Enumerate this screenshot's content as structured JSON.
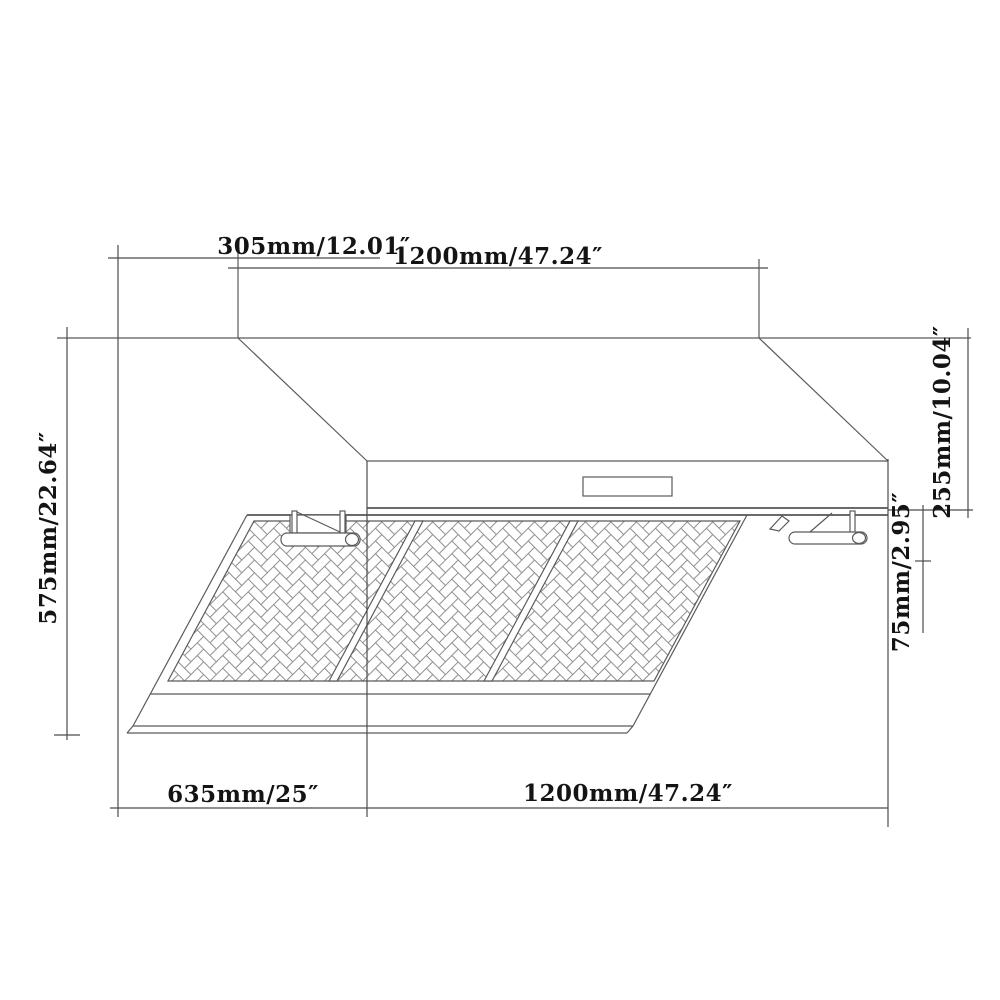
{
  "diagram": {
    "title": "Range hood dimension drawing",
    "view": "oblique front-bottom view with baffle filters",
    "labels": {
      "duct_depth": "305mm/12.01″",
      "duct_width": "1200mm/47.24″",
      "total_height": "575mm/22.64″",
      "canopy_height": "255mm/10.04″",
      "filter_drop": "75mm/2.95″",
      "hood_depth": "635mm/25″",
      "hood_width": "1200mm/47.24″"
    },
    "colors": {
      "background": "#ffffff",
      "outline": "#5a5a5a",
      "dimension_line": "#4c4c4c",
      "pattern_line": "#8f8f8f",
      "text": "#141414"
    }
  }
}
